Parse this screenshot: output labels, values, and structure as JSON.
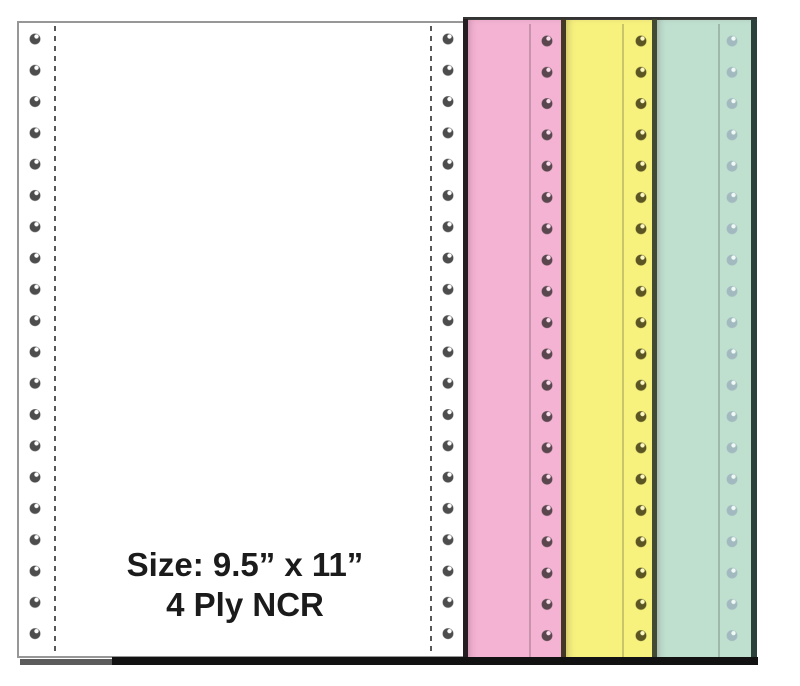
{
  "image": {
    "caption": {
      "line1": "Size: 9.5” x 11”",
      "line2": "4 Ply NCR"
    },
    "sheets": [
      {
        "name": "white",
        "paper_color": "#ffffff",
        "hole_color": "#4d4d4d",
        "hole_highlight": "#ffffff",
        "hole_columns": 2,
        "holes_per_column": 20
      },
      {
        "name": "pink",
        "paper_color": "#f4b3d3",
        "hole_color": "#5a474e",
        "hole_highlight": "#fbdcec",
        "hole_columns": 1,
        "holes_per_column": 20
      },
      {
        "name": "yellow",
        "paper_color": "#f7f17e",
        "hole_color": "#5b5523",
        "hole_highlight": "#fdf9c4",
        "hole_columns": 1,
        "holes_per_column": 20
      },
      {
        "name": "green",
        "paper_color": "#bfe0cf",
        "hole_color": "#a2b9c0",
        "hole_highlight": "#f0faf5",
        "hole_columns": 1,
        "holes_per_column": 20
      }
    ]
  }
}
